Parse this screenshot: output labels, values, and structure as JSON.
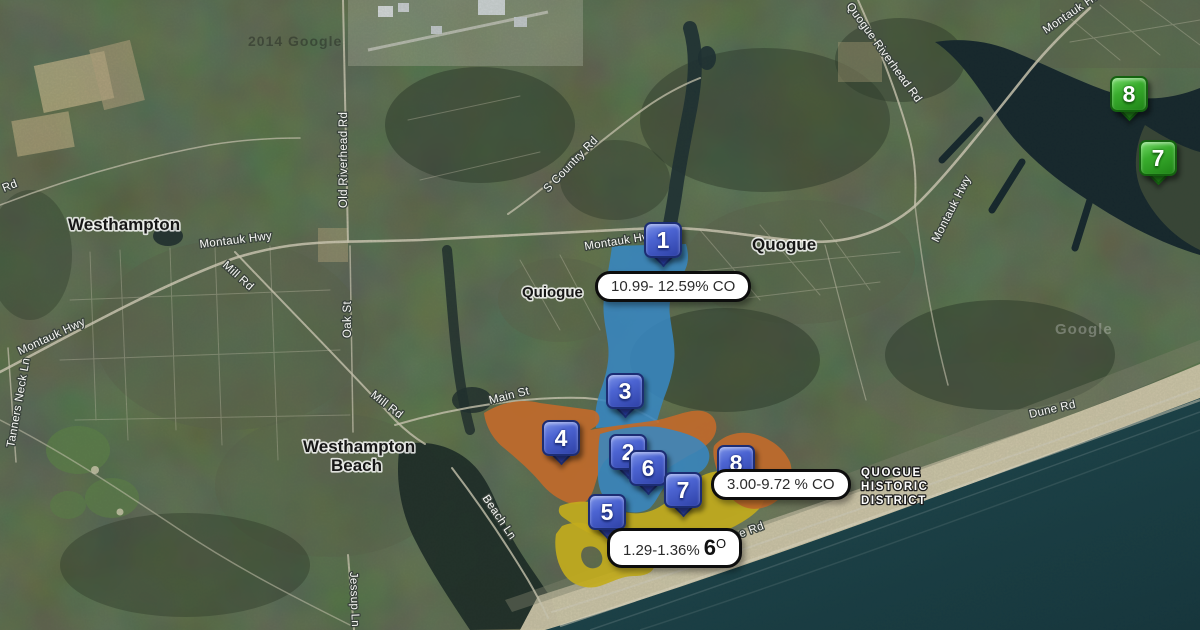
{
  "places": {
    "westhampton": "Westhampton",
    "quiogue": "Quiogue",
    "quogue": "Quogue",
    "westhampton_beach_line1": "Westhampton",
    "westhampton_beach_line2": "Beach",
    "historic_line1": "QUOGUE",
    "historic_line2": "HISTORIC",
    "historic_line3": "DISTRICT"
  },
  "roads": {
    "rd_fragment": "Rd",
    "montauk_hwy_west": "Montauk Hwy",
    "tanners_neck_ln": "Tanners Neck Ln",
    "montauk_hwy_main": "Montauk Hwy",
    "mill_rd_upper": "Mill Rd",
    "old_riverhead_rd": "Old Riverhead Rd",
    "oak_st": "Oak St",
    "mill_rd_lower": "Mill Rd",
    "main_st": "Main St",
    "s_country_rd": "S Country Rd",
    "montauk_hwy_center": "Montauk Hwy",
    "beach_ln": "Beach Ln",
    "jessup_ln": "Jessup Ln",
    "quogue_riverhead_rd": "Quogue Riverhead Rd",
    "montauk_hwy_ne": "Montauk Hw",
    "montauk_hwy_east": "Montauk Hwy",
    "dune_rd_east": "Dune Rd",
    "dune_rd_west": "Dune Rd"
  },
  "watermarks": {
    "attribution_left": "2014 Google",
    "attribution_right": "Google"
  },
  "markers": {
    "b1": {
      "number": "1"
    },
    "b3": {
      "number": "3"
    },
    "b4": {
      "number": "4"
    },
    "b2": {
      "number": "2"
    },
    "b6": {
      "number": "6"
    },
    "b7": {
      "number": "7"
    },
    "b8": {
      "number": "8"
    },
    "b5": {
      "number": "5"
    },
    "g8": {
      "number": "8"
    },
    "g7": {
      "number": "7"
    }
  },
  "tooltips": {
    "zone1": "10.99- 12.59% CO",
    "zone2": "3.00-9.72 % CO",
    "zone3_range": "1.29-1.36%",
    "zone3_six": "6",
    "zone3_o": "O"
  },
  "zone_colors": {
    "blue_zone": "#3886c0",
    "orange_zone": "#c06a2b",
    "yellow_zone": "#c2ab1d",
    "marker_blue": "#3b55c4",
    "marker_green": "#2f9e27"
  }
}
